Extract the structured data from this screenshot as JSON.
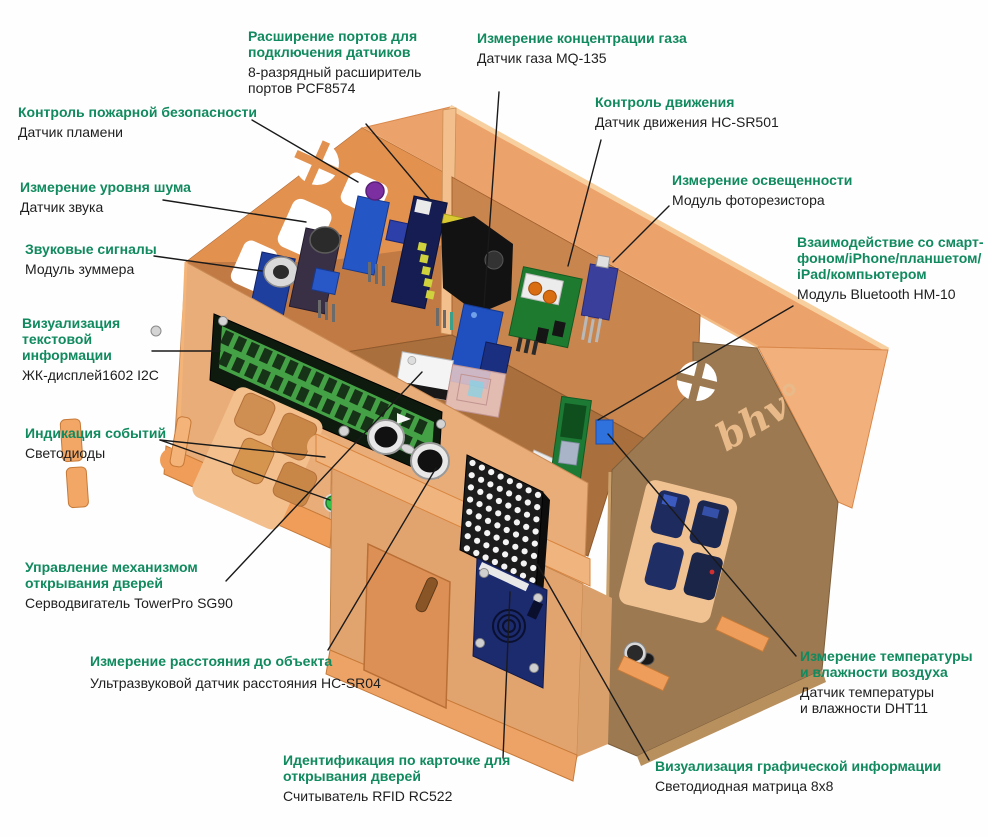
{
  "figure": {
    "kind": "labeled-diagram",
    "subject": "smart-house wooden model with electronic modules",
    "width": 988,
    "height": 837,
    "background": "#ffffff"
  },
  "palette": {
    "label_title_green": "#108a5e",
    "label_body_black": "#1e1e1e",
    "leader_line": "#1a1a1a",
    "roof": "#eca26b",
    "roof_trim": "#f8cf9e",
    "gable_wall": "#c17a44",
    "pediment": "#e2914e",
    "back_wall": "#c9854e",
    "floor": "#a96f3c",
    "front_wall": "#e9ad79",
    "porch": "#e2a46f",
    "right_wall": "#9c7950",
    "base": "#ef9d58",
    "lcd_green": "#45a145",
    "pcb_blue": "#1e3f9e",
    "pcb_green": "#1e7a2f",
    "rfid_navy": "#1c2a6e"
  },
  "house": {
    "logo": "bhv°"
  },
  "callouts": [
    {
      "id": "port-expander",
      "title": [
        "Расширение портов для",
        "подключения датчиков"
      ],
      "body": [
        "8-разрядный расширитель",
        "портов PCF8574"
      ]
    },
    {
      "id": "gas",
      "title": [
        "Измерение концентрации газа"
      ],
      "body": [
        "Датчик газа MQ-135"
      ]
    },
    {
      "id": "motion",
      "title": [
        "Контроль движения"
      ],
      "body": [
        "Датчик движения HC-SR501"
      ]
    },
    {
      "id": "light",
      "title": [
        "Измерение освещенности"
      ],
      "body": [
        "Модуль фоторезистора"
      ]
    },
    {
      "id": "bluetooth",
      "title": [
        "Взаимодействие со смарт-",
        "фоном/iPhone/планшетом/",
        "iPad/компьютером"
      ],
      "body": [
        "Модуль Bluetooth HM-10"
      ]
    },
    {
      "id": "dht11",
      "title": [
        "Измерение температуры",
        "и влажности воздуха"
      ],
      "body": [
        "Датчик температуры",
        "и влажности DHT11"
      ]
    },
    {
      "id": "led-matrix",
      "title": [
        "Визуализация графической информации"
      ],
      "body": [
        "Светодиодная матрица 8x8"
      ]
    },
    {
      "id": "rfid",
      "title": [
        "Идентификация по карточке для",
        "открывания дверей"
      ],
      "body": [
        "Считыватель RFID RC522"
      ]
    },
    {
      "id": "distance",
      "title": [
        "Измерение расстояния до объекта"
      ],
      "body": [
        "Ультразвуковой датчик расстояния HC-SR04"
      ]
    },
    {
      "id": "servo",
      "title": [
        "Управление механизмом",
        "открывания дверей"
      ],
      "body": [
        "Серводвигатель TowerPro SG90"
      ]
    },
    {
      "id": "events",
      "title": [
        "Индикация событий"
      ],
      "body": [
        "Светодиоды"
      ]
    },
    {
      "id": "lcd",
      "title": [
        "Визуализация",
        "текстовой",
        "информации"
      ],
      "body": [
        "ЖК-дисплей1602 I2C"
      ]
    },
    {
      "id": "buzzer",
      "title": [
        "Звуковые сигналы"
      ],
      "body": [
        "Модуль зуммера"
      ]
    },
    {
      "id": "noise",
      "title": [
        "Измерение уровня шума"
      ],
      "body": [
        "Датчик звука"
      ]
    },
    {
      "id": "fire",
      "title": [
        "Контроль пожарной безопасности"
      ],
      "body": [
        "Датчик пламени"
      ]
    }
  ]
}
